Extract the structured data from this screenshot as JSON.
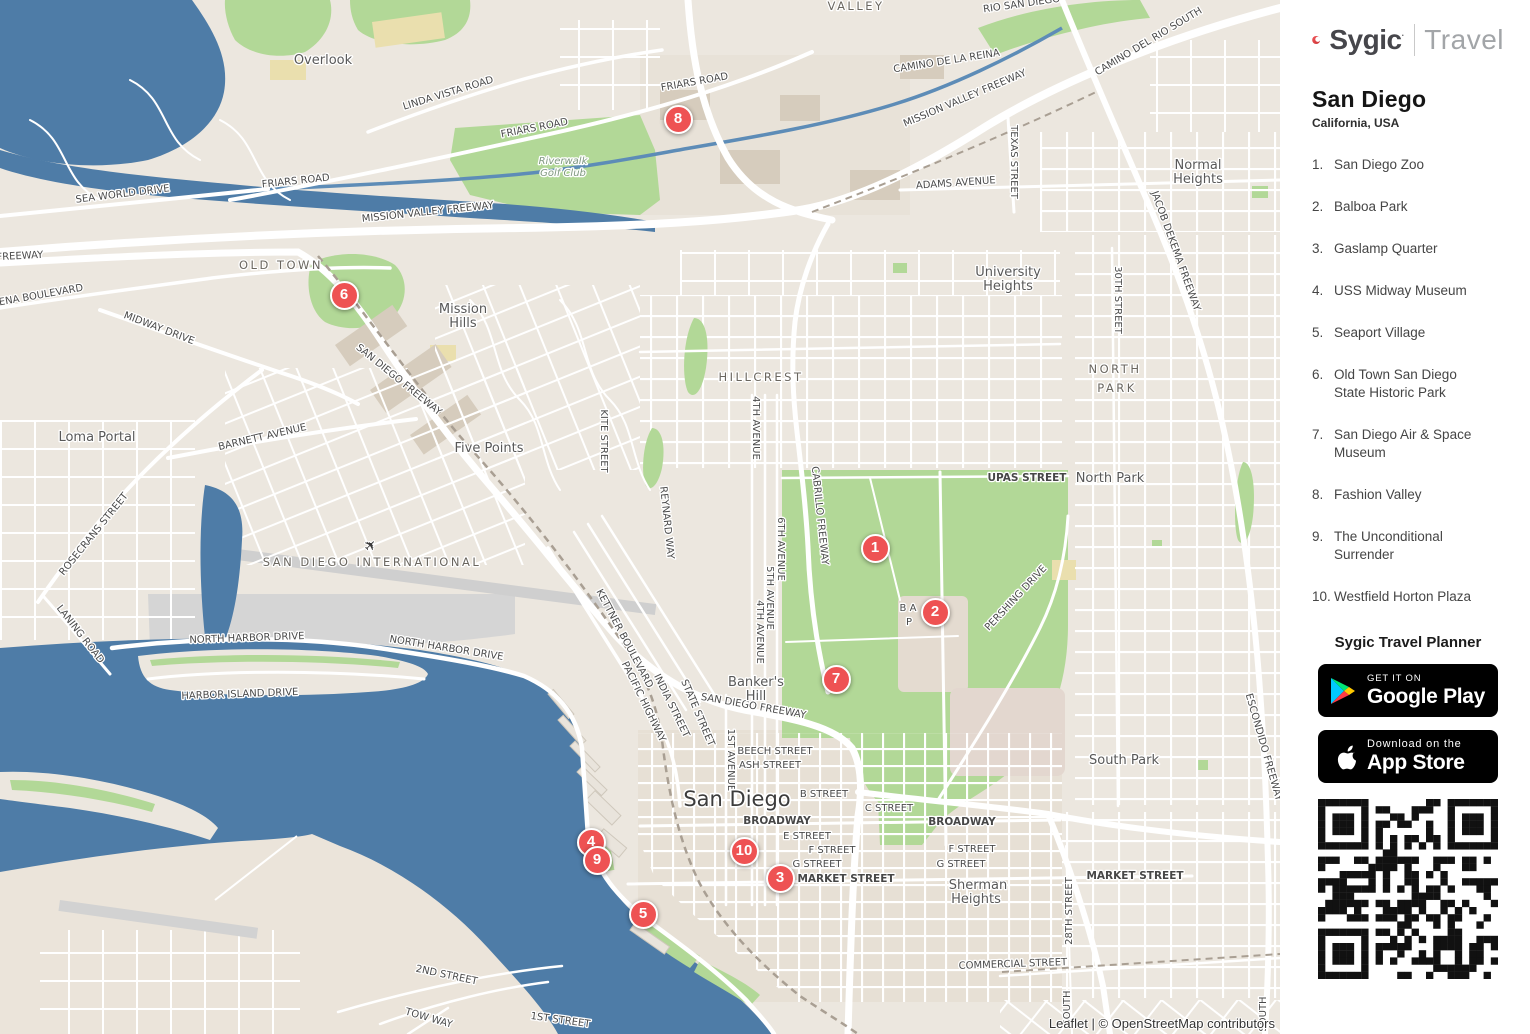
{
  "sidebar": {
    "brand": {
      "name": "Sygic",
      "mark": "·",
      "suffix": "Travel"
    },
    "title": "San Diego",
    "subtitle": "California, USA",
    "places": [
      {
        "num": "1.",
        "name": "San Diego Zoo"
      },
      {
        "num": "2.",
        "name": "Balboa Park"
      },
      {
        "num": "3.",
        "name": "Gaslamp Quarter"
      },
      {
        "num": "4.",
        "name": "USS Midway Museum"
      },
      {
        "num": "5.",
        "name": "Seaport Village"
      },
      {
        "num": "6.",
        "name": "Old Town San Diego State Historic Park"
      },
      {
        "num": "7.",
        "name": "San Diego Air & Space Museum"
      },
      {
        "num": "8.",
        "name": "Fashion Valley"
      },
      {
        "num": "9.",
        "name": "The Unconditional Surrender"
      },
      {
        "num": "10.",
        "name": "Westfield Horton Plaza"
      }
    ],
    "planner_heading": "Sygic Travel Planner",
    "google_play": {
      "line1": "GET IT ON",
      "line2": "Google Play"
    },
    "app_store": {
      "line1": "Download on the",
      "line2": "App Store"
    }
  },
  "map": {
    "attribution": "Leaflet | © OpenStreetMap contributors",
    "colors": {
      "water": "#4e7ca7",
      "land": "#ece7df",
      "park_green": "#b2d897",
      "marker_red": "#ee5253"
    },
    "markers": [
      {
        "n": "1",
        "x": 875,
        "y": 548
      },
      {
        "n": "2",
        "x": 935,
        "y": 612
      },
      {
        "n": "3",
        "x": 780,
        "y": 878
      },
      {
        "n": "4",
        "x": 591,
        "y": 842
      },
      {
        "n": "5",
        "x": 643,
        "y": 914
      },
      {
        "n": "6",
        "x": 344,
        "y": 295
      },
      {
        "n": "7",
        "x": 836,
        "y": 679
      },
      {
        "n": "8",
        "x": 678,
        "y": 119
      },
      {
        "n": "9",
        "x": 597,
        "y": 860
      },
      {
        "n": "10",
        "x": 744,
        "y": 851
      }
    ],
    "labels": [
      {
        "t": "VALLEY",
        "x": 856,
        "y": 10,
        "r": 0,
        "c": "hood"
      },
      {
        "t": "RIO SAN DIEGO",
        "x": 1022,
        "y": 7,
        "r": -8,
        "c": "st"
      },
      {
        "t": "CAMINO DE LA REINA",
        "x": 947,
        "y": 64,
        "r": -9,
        "c": "st"
      },
      {
        "t": "CAMINO DEL RIO SOUTH",
        "x": 1150,
        "y": 44,
        "r": -31,
        "c": "st"
      },
      {
        "t": "MISSION VALLEY FREEWAY",
        "x": 966,
        "y": 101,
        "r": -23,
        "c": "st"
      },
      {
        "t": "FRIARS ROAD",
        "x": 695,
        "y": 85,
        "r": -10,
        "c": "st"
      },
      {
        "t": "FRIARS ROAD",
        "x": 535,
        "y": 131,
        "r": -11,
        "c": "st"
      },
      {
        "t": "FRIARS ROAD",
        "x": 296,
        "y": 184,
        "r": -6,
        "c": "st"
      },
      {
        "t": "Overlook",
        "x": 323,
        "y": 64,
        "r": 0,
        "c": "hood2"
      },
      {
        "t": "LINDA VISTA ROAD",
        "x": 449,
        "y": 96,
        "r": -17,
        "c": "st"
      },
      {
        "t": "Riverwalk",
        "x": 563,
        "y": 164,
        "r": 0,
        "c": "park"
      },
      {
        "t": "Golf Club",
        "x": 563,
        "y": 176,
        "r": 0,
        "c": "park"
      },
      {
        "t": "SEA WORLD DRIVE",
        "x": 123,
        "y": 197,
        "r": -7,
        "c": "st"
      },
      {
        "t": "MISSION VALLEY FREEWAY",
        "x": 428,
        "y": 215,
        "r": -6,
        "c": "st"
      },
      {
        "t": "ADAMS AVENUE",
        "x": 956,
        "y": 186,
        "r": -4,
        "c": "st"
      },
      {
        "t": "TEXAS STREET",
        "x": 1011,
        "y": 162,
        "r": 90,
        "c": "st"
      },
      {
        "t": "Normal",
        "x": 1198,
        "y": 169,
        "r": 0,
        "c": "hood2"
      },
      {
        "t": "Heights",
        "x": 1198,
        "y": 183,
        "r": 0,
        "c": "hood2"
      },
      {
        "t": "JACOB DEKEMA FREEWAY",
        "x": 1173,
        "y": 252,
        "r": 70,
        "c": "st"
      },
      {
        "t": "University",
        "x": 1008,
        "y": 276,
        "r": 0,
        "c": "hood2"
      },
      {
        "t": "Heights",
        "x": 1008,
        "y": 290,
        "r": 0,
        "c": "hood2"
      },
      {
        "t": "30TH STREET",
        "x": 1115,
        "y": 300,
        "r": 90,
        "c": "st"
      },
      {
        "t": "OLD TOWN",
        "x": 281,
        "y": 269,
        "r": 0,
        "c": "hood"
      },
      {
        "t": "MORENA BOULEVARD",
        "x": 30,
        "y": 300,
        "r": -10,
        "c": "st"
      },
      {
        "t": "FREEWAY",
        "x": 20,
        "y": 259,
        "r": -3,
        "c": "st"
      },
      {
        "t": "Mission",
        "x": 463,
        "y": 313,
        "r": 0,
        "c": "hood2"
      },
      {
        "t": "Hills",
        "x": 463,
        "y": 327,
        "r": 0,
        "c": "hood2"
      },
      {
        "t": "SAN DIEGO FREEWAY",
        "x": 397,
        "y": 382,
        "r": 39,
        "c": "st"
      },
      {
        "t": "MIDWAY DRIVE",
        "x": 158,
        "y": 331,
        "r": 21,
        "c": "st"
      },
      {
        "t": "BARNETT AVENUE",
        "x": 263,
        "y": 440,
        "r": -13,
        "c": "st"
      },
      {
        "t": "Loma Portal",
        "x": 97,
        "y": 441,
        "r": 0,
        "c": "hood2"
      },
      {
        "t": "ROSECRANS STREET",
        "x": 96,
        "y": 536,
        "r": -51,
        "c": "st"
      },
      {
        "t": "Five Points",
        "x": 489,
        "y": 452,
        "r": 0,
        "c": "hood2"
      },
      {
        "t": "KITE STREET",
        "x": 601,
        "y": 441,
        "r": 90,
        "c": "st"
      },
      {
        "t": "REYNARD WAY",
        "x": 664,
        "y": 523,
        "r": 84,
        "c": "st"
      },
      {
        "t": "HILLCREST",
        "x": 761,
        "y": 381,
        "r": 0,
        "c": "hood"
      },
      {
        "t": "4TH AVENUE",
        "x": 753,
        "y": 428,
        "r": 90,
        "c": "st"
      },
      {
        "t": "CABRILLO FREEWAY",
        "x": 817,
        "y": 516,
        "r": 84,
        "c": "st"
      },
      {
        "t": "6TH AVENUE",
        "x": 778,
        "y": 549,
        "r": 90,
        "c": "st"
      },
      {
        "t": "5TH AVENUE",
        "x": 767,
        "y": 598,
        "r": 90,
        "c": "st"
      },
      {
        "t": "4TH AVENUE",
        "x": 757,
        "y": 632,
        "r": 90,
        "c": "st"
      },
      {
        "t": "UPAS STREET",
        "x": 1027,
        "y": 481,
        "r": 0,
        "c": "stB"
      },
      {
        "t": "North Park",
        "x": 1110,
        "y": 482,
        "r": 0,
        "c": "hood2"
      },
      {
        "t": "NORTH",
        "x": 1115,
        "y": 373,
        "r": 0,
        "c": "hood"
      },
      {
        "t": "PARK",
        "x": 1117,
        "y": 392,
        "r": 0,
        "c": "hood"
      },
      {
        "t": "PERSHING DRIVE",
        "x": 1018,
        "y": 600,
        "r": -47,
        "c": "st"
      },
      {
        "t": "South Park",
        "x": 1124,
        "y": 764,
        "r": 0,
        "c": "hood2"
      },
      {
        "t": "LANING ROAD",
        "x": 78,
        "y": 636,
        "r": 52,
        "c": "st"
      },
      {
        "t": "NORTH HARBOR DRIVE",
        "x": 247,
        "y": 641,
        "r": -2,
        "c": "st"
      },
      {
        "t": "NORTH HARBOR DRIVE",
        "x": 446,
        "y": 651,
        "r": 9,
        "c": "st"
      },
      {
        "t": "HARBOR ISLAND DRIVE",
        "x": 240,
        "y": 697,
        "r": -2,
        "c": "st"
      },
      {
        "t": "SAN DIEGO INTERNATIONAL",
        "x": 372,
        "y": 566,
        "r": 0,
        "c": "hood"
      },
      {
        "t": "✈",
        "x": 374,
        "y": 549,
        "r": -45,
        "c": "plane"
      },
      {
        "t": "KETTNER BOULEVARD",
        "x": 622,
        "y": 640,
        "r": 62,
        "c": "st"
      },
      {
        "t": "PACIFIC HIGHWAY",
        "x": 641,
        "y": 703,
        "r": 64,
        "c": "st"
      },
      {
        "t": "INDIA STREET",
        "x": 669,
        "y": 707,
        "r": 64,
        "c": "st"
      },
      {
        "t": "STATE STREET",
        "x": 695,
        "y": 714,
        "r": 67,
        "c": "st"
      },
      {
        "t": "SAN DIEGO FREEWAY",
        "x": 753,
        "y": 709,
        "r": 10,
        "c": "st"
      },
      {
        "t": "Banker's",
        "x": 756,
        "y": 686,
        "r": 0,
        "c": "hood2"
      },
      {
        "t": "Hill",
        "x": 756,
        "y": 700,
        "r": 0,
        "c": "hood2"
      },
      {
        "t": "1ST AVENUE",
        "x": 728,
        "y": 760,
        "r": 90,
        "c": "st"
      },
      {
        "t": "San Diego",
        "x": 737,
        "y": 806,
        "r": 0,
        "c": "city"
      },
      {
        "t": "BEECH STREET",
        "x": 775,
        "y": 754,
        "r": 0,
        "c": "st"
      },
      {
        "t": "ASH STREET",
        "x": 770,
        "y": 768,
        "r": 0,
        "c": "st"
      },
      {
        "t": "B STREET",
        "x": 824,
        "y": 797,
        "r": 0,
        "c": "st"
      },
      {
        "t": "C STREET",
        "x": 889,
        "y": 811,
        "r": 0,
        "c": "st"
      },
      {
        "t": "BROADWAY",
        "x": 777,
        "y": 824,
        "r": 0,
        "c": "stB"
      },
      {
        "t": "BROADWAY",
        "x": 962,
        "y": 825,
        "r": 0,
        "c": "stB"
      },
      {
        "t": "E STREET",
        "x": 807,
        "y": 839,
        "r": 0,
        "c": "st"
      },
      {
        "t": "F STREET",
        "x": 832,
        "y": 853,
        "r": 0,
        "c": "st"
      },
      {
        "t": "F STREET",
        "x": 972,
        "y": 852,
        "r": 0,
        "c": "st"
      },
      {
        "t": "G STREET",
        "x": 817,
        "y": 867,
        "r": 0,
        "c": "st"
      },
      {
        "t": "G STREET",
        "x": 961,
        "y": 867,
        "r": 0,
        "c": "st"
      },
      {
        "t": "MARKET STREET",
        "x": 846,
        "y": 882,
        "r": 0,
        "c": "stB"
      },
      {
        "t": "MARKET STREET",
        "x": 1135,
        "y": 879,
        "r": 0,
        "c": "stB"
      },
      {
        "t": "Sherman",
        "x": 978,
        "y": 889,
        "r": 0,
        "c": "hood2"
      },
      {
        "t": "Heights",
        "x": 976,
        "y": 903,
        "r": 0,
        "c": "hood2"
      },
      {
        "t": "COMMERCIAL STREET",
        "x": 1013,
        "y": 967,
        "r": -2,
        "c": "st"
      },
      {
        "t": "28TH STREET",
        "x": 1072,
        "y": 911,
        "r": -90,
        "c": "st"
      },
      {
        "t": "2ND STREET",
        "x": 446,
        "y": 978,
        "r": 12,
        "c": "st"
      },
      {
        "t": "TOW WAY",
        "x": 428,
        "y": 1021,
        "r": 16,
        "c": "st"
      },
      {
        "t": "1ST STREET",
        "x": 560,
        "y": 1023,
        "r": 8,
        "c": "st"
      },
      {
        "t": "ESCONDIDO FREEWAY",
        "x": 1261,
        "y": 748,
        "r": 74,
        "c": "st"
      },
      {
        "t": "B A",
        "x": 908,
        "y": 611,
        "r": 0,
        "c": "st"
      },
      {
        "t": "P",
        "x": 909,
        "y": 625,
        "r": 0,
        "c": "st"
      },
      {
        "t": "SOUTH",
        "x": 1070,
        "y": 1008,
        "r": -90,
        "c": "st"
      },
      {
        "t": "SOUTH",
        "x": 1266,
        "y": 1014,
        "r": -90,
        "c": "st"
      }
    ]
  }
}
